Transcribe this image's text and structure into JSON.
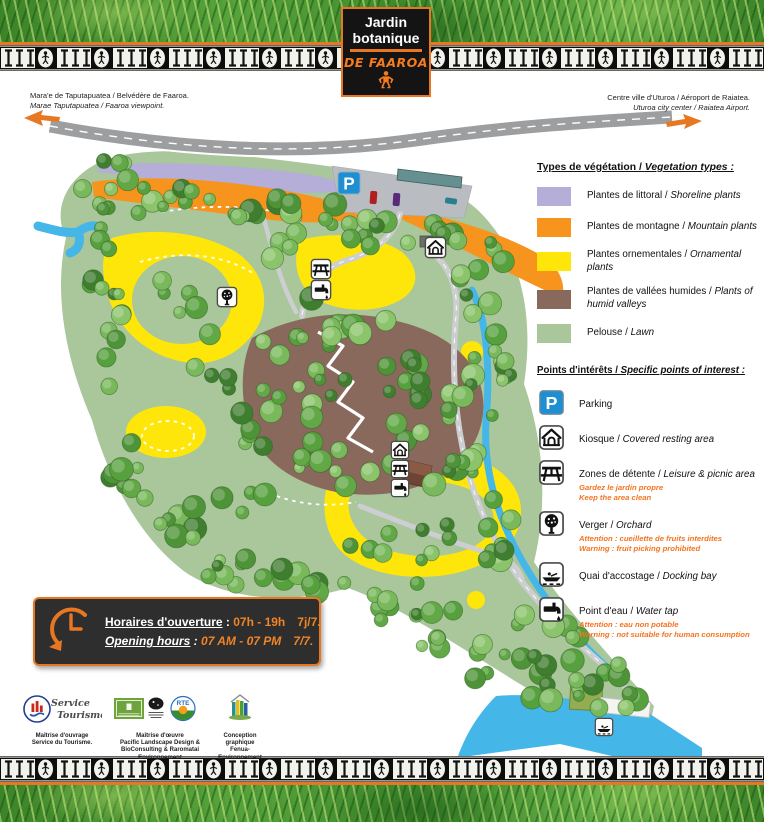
{
  "title": {
    "line1": "Jardin",
    "line2": "botanique",
    "subtitle": "DE FAAROA"
  },
  "directions": {
    "left": {
      "fr": "Mara'e de Taputapuatea / Belvédère de Faaroa.",
      "en": "Marae Taputapuatea / Faaroa viewpoint."
    },
    "right": {
      "fr": "Centre ville d'Uturoa / Aéroport de Raiatea.",
      "en": "Uturoa city center / Raiatea Airport."
    }
  },
  "vegetation": {
    "title_fr": "Types de végétation /",
    "title_en": "Vegetation types :",
    "items": [
      {
        "color": "#b4aed8",
        "fr": "Plantes de littoral /",
        "en": "Shoreline plants"
      },
      {
        "color": "#f7941e",
        "fr": "Plantes de montagne /",
        "en": "Mountain plants"
      },
      {
        "color": "#ffe60a",
        "fr": "Plantes ornementales /",
        "en": "Ornamental plants"
      },
      {
        "color": "#8a695d",
        "fr": "Plantes de vallées humides /",
        "en": "Plants of humid valleys"
      },
      {
        "color": "#aac69b",
        "fr": "Pelouse /",
        "en": "Lawn"
      }
    ]
  },
  "poi": {
    "title_fr": "Points d'intérêts /",
    "title_en": "Specific points of interest :",
    "items": [
      {
        "icon": "parking",
        "fr": "Parking",
        "en": "",
        "warn_fr": "",
        "warn_en": ""
      },
      {
        "icon": "kiosk",
        "fr": "Kiosque /",
        "en": "Covered resting area",
        "warn_fr": "",
        "warn_en": ""
      },
      {
        "icon": "picnic",
        "fr": "Zones de détente /",
        "en": "Leisure & picnic area",
        "warn_fr": "Gardez le jardin propre",
        "warn_en": "Keep the area clean"
      },
      {
        "icon": "orchard",
        "fr": "Verger /",
        "en": "Orchard",
        "warn_fr": "Attention : cueillette de fruits interdites",
        "warn_en": "Warning : fruit picking prohibited"
      },
      {
        "icon": "dock",
        "fr": "Quai d'accostage /",
        "en": "Docking bay",
        "warn_fr": "",
        "warn_en": ""
      },
      {
        "icon": "tap",
        "fr": "Point d'eau /",
        "en": "Water tap",
        "warn_fr": "Attention : eau non potable",
        "warn_en": "Warning : not suitable for human consumption"
      }
    ]
  },
  "hours": {
    "fr_label": "Horaires d'ouverture",
    "fr_sep": " : ",
    "fr_value": "07h - 19h",
    "fr_days": "7j/7.",
    "en_label": "Opening hours",
    "en_sep": " : ",
    "en_value": "07 AM - 07 PM",
    "en_days": "7/7."
  },
  "credits": [
    {
      "logo": "service-tourisme",
      "line1": "Maîtrise d'ouvrage",
      "line2": "Service du Tourisme."
    },
    {
      "logo": "pld-bio-rte",
      "line1": "Maîtrise d'œuvre",
      "line2": "Pacific Landscape Design & BioConsulting & Raromatai Environnement"
    },
    {
      "logo": "fenua",
      "line1": "Conception graphique",
      "line2": "Fenua-Environnement"
    }
  ],
  "logo_texts": {
    "service_tourisme_l1": "Service",
    "service_tourisme_l2": "Tourisme",
    "rte": "RTE"
  },
  "map": {
    "parking_letter": "P",
    "markers": [
      "parking-sign",
      "kiosk",
      "picnic",
      "water-tap",
      "orchard",
      "kiosk",
      "picnic",
      "water-tap",
      "docking-bay"
    ]
  },
  "colors": {
    "accent_orange": "#e87722",
    "legend_orange": "#f7941e",
    "lavender": "#b4aed8",
    "yellow": "#ffe60a",
    "brown": "#8a695d",
    "lawn": "#aac69b",
    "water": "#45b6e8",
    "road": "#9c9ea0",
    "parking_blue": "#1f8fd4",
    "warning_text": "#f4731f"
  }
}
